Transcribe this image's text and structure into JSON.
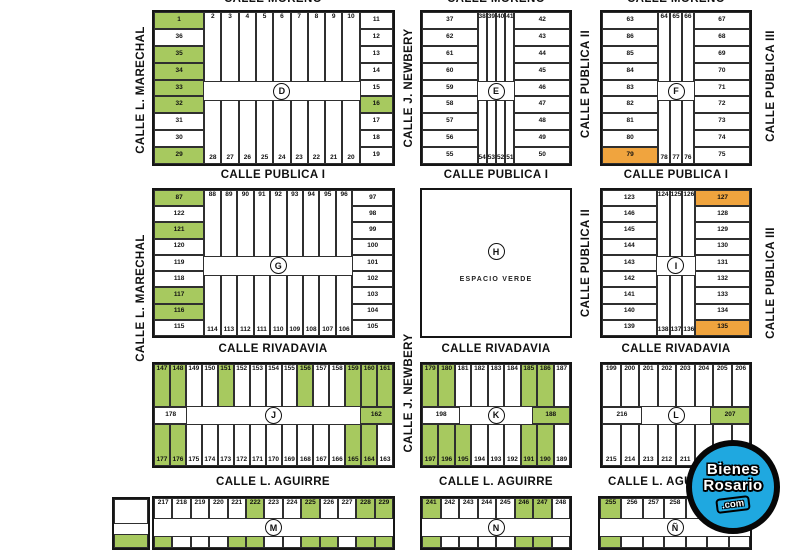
{
  "colors": {
    "green": "#a7c95f",
    "orange": "#f0a43e",
    "line": "#2f2f2f",
    "logo_blue": "#1fa8e0"
  },
  "logo": {
    "line1": "Bienes",
    "line2": "Rosario",
    "line3": ".com"
  },
  "espacio_verde_label": "ESPACIO VERDE",
  "streets": {
    "horizontal": [
      {
        "label": "CALLE MORENO",
        "x": 273,
        "y": -7
      },
      {
        "label": "CALLE MORENO",
        "x": 496,
        "y": -7
      },
      {
        "label": "CALLE MORENO",
        "x": 676,
        "y": -7
      },
      {
        "label": "CALLE PUBLICA I",
        "x": 273,
        "y": 169
      },
      {
        "label": "CALLE PUBLICA I",
        "x": 496,
        "y": 169
      },
      {
        "label": "CALLE PUBLICA I",
        "x": 676,
        "y": 169
      },
      {
        "label": "CALLE RIVADAVIA",
        "x": 273,
        "y": 343
      },
      {
        "label": "CALLE RIVADAVIA",
        "x": 496,
        "y": 343
      },
      {
        "label": "CALLE RIVADAVIA",
        "x": 676,
        "y": 343
      },
      {
        "label": "CALLE L. AGUIRRE",
        "x": 273,
        "y": 476
      },
      {
        "label": "CALLE L. AGUIRRE",
        "x": 496,
        "y": 476
      },
      {
        "label": "CALLE L. AGUIRRE",
        "x": 665,
        "y": 476
      }
    ],
    "vertical": [
      {
        "label": "CALLE L. MARECHAL",
        "x": 141,
        "y": 90
      },
      {
        "label": "CALLE L. MARECHAL",
        "x": 141,
        "y": 298
      },
      {
        "label": "CALLE J. NEWBERY",
        "x": 409,
        "y": 88
      },
      {
        "label": "CALLE J. NEWBERY",
        "x": 409,
        "y": 393
      },
      {
        "label": "CALLE PUBLICA II",
        "x": 586,
        "y": 84
      },
      {
        "label": "CALLE PUBLICA II",
        "x": 586,
        "y": 263
      },
      {
        "label": "CALLE PUBLICA III",
        "x": 771,
        "y": 86
      },
      {
        "label": "CALLE PUBLICA III",
        "x": 771,
        "y": 283
      }
    ]
  },
  "blocks": [
    {
      "letter": "D",
      "type": "perimeter",
      "x": 152,
      "y": 10,
      "w": 243,
      "h": 156,
      "leftW": 21,
      "rightW": 14,
      "left": [
        "1g",
        "36",
        "35g",
        "34g",
        "33g",
        "32g",
        "31",
        "30",
        "29g"
      ],
      "top": [
        "2",
        "3",
        "4",
        "5",
        "6",
        "7",
        "8",
        "9",
        "10"
      ],
      "right": [
        "11",
        "12",
        "13",
        "14",
        "15",
        "16g",
        "17",
        "18",
        "19"
      ],
      "bottom": [
        "28",
        "27",
        "26",
        "25",
        "24",
        "23",
        "22",
        "21",
        "20"
      ]
    },
    {
      "letter": "E",
      "type": "perimeter",
      "x": 420,
      "y": 10,
      "w": 152,
      "h": 156,
      "leftW": 38,
      "rightW": 38,
      "left": [
        "37",
        "62",
        "61",
        "60",
        "59",
        "58",
        "57",
        "56",
        "55"
      ],
      "top": [
        "38",
        "39",
        "40",
        "41"
      ],
      "right": [
        "42",
        "43",
        "44",
        "45",
        "46",
        "47",
        "48",
        "49",
        "50"
      ],
      "bottom": [
        "54",
        "53",
        "52",
        "51"
      ]
    },
    {
      "letter": "F",
      "type": "perimeter",
      "x": 600,
      "y": 10,
      "w": 152,
      "h": 156,
      "leftW": 38,
      "rightW": 38,
      "left": [
        "63",
        "86",
        "85",
        "84",
        "83",
        "82",
        "81",
        "80",
        "79o"
      ],
      "top": [
        "64",
        "65",
        "66"
      ],
      "right": [
        "67",
        "68",
        "69",
        "70",
        "71",
        "72",
        "73",
        "74",
        "75"
      ],
      "bottom": [
        "78",
        "77",
        "76"
      ]
    },
    {
      "letter": "G",
      "type": "perimeter",
      "x": 152,
      "y": 188,
      "w": 243,
      "h": 150,
      "leftW": 21,
      "rightW": 17,
      "left": [
        "87g",
        "122",
        "121g",
        "120",
        "119",
        "118",
        "117g",
        "116g",
        "115"
      ],
      "top": [
        "88",
        "89",
        "90",
        "91",
        "92",
        "93",
        "94",
        "95",
        "96"
      ],
      "right": [
        "97",
        "98",
        "99",
        "100",
        "101",
        "102",
        "103",
        "104",
        "105"
      ],
      "bottom": [
        "114",
        "113",
        "112",
        "111",
        "110",
        "109",
        "108",
        "107",
        "106"
      ]
    },
    {
      "letter": "H",
      "type": "open",
      "x": 420,
      "y": 188,
      "w": 152,
      "h": 150
    },
    {
      "letter": "I",
      "type": "perimeter",
      "x": 600,
      "y": 188,
      "w": 152,
      "h": 150,
      "leftW": 38,
      "rightW": 38,
      "left": [
        "123",
        "146",
        "145",
        "144",
        "143",
        "142",
        "141",
        "140",
        "139"
      ],
      "top": [
        "124",
        "125",
        "126"
      ],
      "right": [
        "127o",
        "128",
        "129",
        "130",
        "131",
        "132",
        "133",
        "134",
        "135o"
      ],
      "bottom": [
        "138",
        "137",
        "136"
      ]
    },
    {
      "letter": "J",
      "type": "ribbon",
      "x": 152,
      "y": 362,
      "w": 243,
      "h": 106,
      "midW": 14,
      "top": [
        "147g",
        "148g",
        "149",
        "150",
        "151g",
        "152",
        "153",
        "154",
        "155",
        "156g",
        "157",
        "158",
        "159g",
        "160g",
        "161g"
      ],
      "midLeft": "178",
      "midRight": "162g",
      "bottom": [
        "177g",
        "176g",
        "175",
        "174",
        "173",
        "172",
        "171",
        "170",
        "169",
        "168",
        "167",
        "166",
        "165g",
        "164g",
        "163"
      ]
    },
    {
      "letter": "K",
      "type": "ribbon",
      "x": 420,
      "y": 362,
      "w": 152,
      "h": 106,
      "midW": 26,
      "top": [
        "179g",
        "180g",
        "181",
        "182",
        "183",
        "184",
        "185g",
        "186g",
        "187"
      ],
      "midLeft": "198",
      "midRight": "188g",
      "bottom": [
        "197g",
        "196g",
        "195g",
        "194",
        "193",
        "192",
        "191g",
        "190g",
        "189"
      ]
    },
    {
      "letter": "L",
      "type": "ribbon",
      "x": 600,
      "y": 362,
      "w": 152,
      "h": 106,
      "midW": 27,
      "top": [
        "199",
        "200",
        "201",
        "202",
        "203",
        "204",
        "205",
        "206"
      ],
      "midLeft": "216",
      "midRight": "207g",
      "bottom": [
        "215",
        "214",
        "213",
        "212",
        "211",
        "210",
        "209",
        "208"
      ]
    },
    {
      "letter": "M",
      "type": "cut",
      "x": 152,
      "y": 496,
      "w": 243,
      "h": 54,
      "top": [
        "217",
        "218",
        "219",
        "220",
        "221",
        "222g",
        "223",
        "224",
        "225g",
        "226",
        "227",
        "228g",
        "229g"
      ],
      "strip": [
        "g",
        "w",
        "w",
        "w",
        "g",
        "g",
        "w",
        "w",
        "g",
        "g",
        "w",
        "g",
        "g"
      ]
    },
    {
      "letter": "N",
      "type": "cut",
      "x": 420,
      "y": 496,
      "w": 152,
      "h": 54,
      "top": [
        "241g",
        "242",
        "243",
        "244",
        "245",
        "246g",
        "247g",
        "248"
      ],
      "strip": [
        "g",
        "w",
        "w",
        "w",
        "w",
        "g",
        "g",
        "w"
      ]
    },
    {
      "letter": "Ñ",
      "id": "enie",
      "type": "cut",
      "x": 598,
      "y": 496,
      "w": 154,
      "h": 54,
      "top": [
        "255g",
        "256",
        "257",
        "258",
        "259",
        "w",
        "w"
      ],
      "strip": [
        "g",
        "w",
        "w",
        "w",
        "w",
        "w",
        "w"
      ]
    },
    {
      "letter": "",
      "id": "partial-west",
      "type": "cut",
      "x": 112,
      "y": 497,
      "w": 38,
      "h": 53,
      "top": [
        "w"
      ],
      "strip": [
        "g"
      ]
    }
  ]
}
